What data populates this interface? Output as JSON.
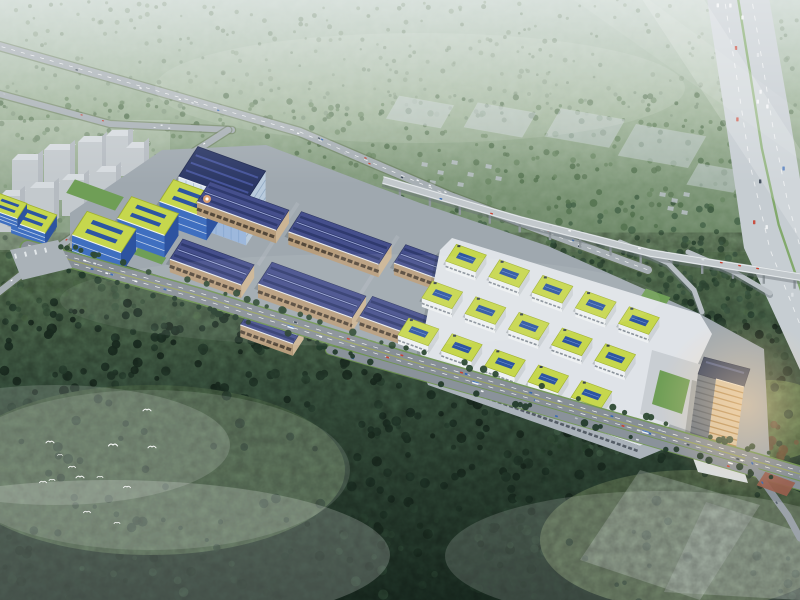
{
  "scene": {
    "canvas": {
      "w": 800,
      "h": 600
    },
    "axes": {
      "u": [
        0.94,
        0.34
      ],
      "v": [
        -0.54,
        0.84
      ],
      "pu": [
        0.97,
        0.17
      ],
      "pv": [
        -0.5,
        0.87
      ]
    },
    "palette": {
      "haze_top": "#b9c9c0",
      "forest_high": "#93ab8e",
      "forest_mid": "#5f7c5a",
      "forest_low": "#3a5541",
      "forest_dark": "#1e3126",
      "road": "#8a939b",
      "road_light": "#a7afb4",
      "verge_green": "#6f9551",
      "viaduct": "#c2c8cc",
      "expressway": "#c6cdd2",
      "median_green": "#7aa560",
      "warehouse_roof": "#454f8c",
      "warehouse_roof_dark": "#2f3a6e",
      "warehouse_wall": "#b79d7c",
      "green_roof": "#c6d74d",
      "green_roof_edge": "#9fb12f",
      "solar_blue": "#2d55a2",
      "glass_blue": "#3f6fc0",
      "hq_face": "#d9e4ef",
      "podium_white": "#dfe3e8",
      "tower_sun": "#d9c5a4",
      "tower_shade": "#6a7582",
      "city_gray": "#b6bdc3",
      "bird_white": "#ffffff",
      "sun_warm": "#ffd9a8"
    },
    "background_stops": [
      [
        0,
        "#b9c9c0"
      ],
      [
        0.18,
        "#99af93"
      ],
      [
        0.42,
        "#607d5a"
      ],
      [
        0.64,
        "#3d5843"
      ],
      [
        1,
        "#1d3025"
      ]
    ],
    "forest_zones": [
      {
        "x": 0,
        "y": 0,
        "w": 800,
        "h": 118,
        "n": 330,
        "r0": 1.2,
        "r1": 2.6,
        "o": 0.55,
        "cols": [
          "#7d947b",
          "#6f876e",
          "#84997f"
        ]
      },
      {
        "x": 0,
        "y": 95,
        "w": 800,
        "h": 125,
        "n": 380,
        "r0": 1.6,
        "r1": 3.2,
        "o": 0.75,
        "cols": [
          "#5d7a58",
          "#51704e",
          "#6a8763"
        ]
      },
      {
        "x": 0,
        "y": 195,
        "w": 800,
        "h": 125,
        "n": 420,
        "r0": 2,
        "r1": 4,
        "o": 0.85,
        "cols": [
          "#47654a",
          "#3c583f",
          "#54724f"
        ]
      },
      {
        "x": 540,
        "y": 238,
        "w": 260,
        "h": 62,
        "n": 95,
        "r0": 2,
        "r1": 3.6,
        "o": 0.9,
        "cols": [
          "#3a573f",
          "#2f4a35",
          "#44624a"
        ]
      },
      {
        "x": 540,
        "y": 280,
        "w": 260,
        "h": 175,
        "n": 250,
        "r0": 2.2,
        "r1": 4.2,
        "o": 0.9,
        "cols": [
          "#3a573f",
          "#2f4a35",
          "#44624a"
        ]
      },
      {
        "x": 0,
        "y": 300,
        "w": 800,
        "h": 300,
        "n": 680,
        "r0": 2.4,
        "r1": 5.2,
        "o": 0.92,
        "cols": [
          "#24392b",
          "#1c2f23",
          "#2d4534",
          "#203427"
        ]
      }
    ],
    "meadows": [
      {
        "cx": 150,
        "cy": 470,
        "rx": 195,
        "ry": 85,
        "fill": "#4f6a4b",
        "o": 0.88,
        "puffs": 42
      },
      {
        "cx": 690,
        "cy": 540,
        "rx": 150,
        "ry": 70,
        "fill": "#5e7454",
        "o": 0.85,
        "puffs": 26
      },
      {
        "cx": 770,
        "cy": 420,
        "rx": 62,
        "ry": 40,
        "fill": "#7fa05f",
        "o": 0.6,
        "puffs": 10
      }
    ],
    "clear_plots": [
      [
        [
          640,
          470
        ],
        [
          760,
          505
        ],
        [
          700,
          600
        ],
        [
          580,
          560
        ]
      ],
      [
        [
          706,
          502
        ],
        [
          800,
          532
        ],
        [
          800,
          600
        ],
        [
          664,
          592
        ]
      ]
    ],
    "red_trees": {
      "x": 728,
      "y": 418,
      "w": 72,
      "h": 58,
      "n": 16,
      "cols": [
        "#6e5a43",
        "#7a5f3f",
        "#585137",
        "#7d6847"
      ]
    },
    "city_blocks": [
      [
        12,
        160,
        26,
        46
      ],
      [
        44,
        150,
        26,
        50
      ],
      [
        78,
        142,
        24,
        46
      ],
      [
        106,
        136,
        22,
        40
      ],
      [
        0,
        196,
        20,
        36
      ],
      [
        30,
        188,
        24,
        40
      ],
      [
        62,
        180,
        22,
        36
      ],
      [
        96,
        172,
        20,
        32
      ],
      [
        126,
        148,
        18,
        34
      ]
    ],
    "gray_houses": [
      [
        422,
        162
      ],
      [
        438,
        170
      ],
      [
        452,
        160
      ],
      [
        468,
        172
      ],
      [
        486,
        164
      ],
      [
        430,
        180
      ],
      [
        458,
        182
      ],
      [
        496,
        176
      ],
      [
        660,
        192
      ],
      [
        672,
        198
      ],
      [
        684,
        192
      ],
      [
        668,
        206
      ],
      [
        682,
        210
      ]
    ],
    "future_plots": [
      {
        "c": [
          420,
          112
        ],
        "a": 28,
        "b": 13
      },
      {
        "c": [
          500,
          120
        ],
        "a": 30,
        "b": 14
      },
      {
        "c": [
          585,
          128
        ],
        "a": 33,
        "b": 16
      },
      {
        "c": [
          662,
          146
        ],
        "a": 36,
        "b": 18
      },
      {
        "c": [
          716,
          178
        ],
        "a": 24,
        "b": 12
      }
    ],
    "roads": {
      "roadA": {
        "pts": [
          [
            -8,
            44
          ],
          [
            140,
            86
          ],
          [
            300,
            132
          ],
          [
            450,
            196
          ],
          [
            575,
            243
          ],
          [
            648,
            270
          ]
        ],
        "w": 8,
        "cars": 22,
        "cs": 0.8
      },
      "roadB": {
        "pts": [
          [
            -8,
            92
          ],
          [
            110,
            124
          ],
          [
            232,
            130
          ]
        ],
        "w": 6,
        "cars": 6,
        "cs": 0.7
      },
      "roadNS": {
        "pts": [
          [
            228,
            130
          ],
          [
            150,
            180
          ],
          [
            80,
            232
          ],
          [
            40,
            260
          ],
          [
            -6,
            296
          ]
        ],
        "w": 6.5,
        "cars": 7,
        "cs": 0.8
      },
      "internal": {
        "pts": [
          [
            90,
            232
          ],
          [
            300,
            298
          ],
          [
            520,
            366
          ],
          [
            700,
            428
          ]
        ],
        "w": 6,
        "cars": 5,
        "cs": 0.9
      }
    },
    "boulevard": {
      "pts": [
        [
          28,
          248
        ],
        [
          200,
          296
        ],
        [
          400,
          358
        ],
        [
          600,
          416
        ],
        [
          800,
          474
        ]
      ],
      "w": 14,
      "cars": 30,
      "cs": 1,
      "buses": [
        0.34,
        0.58,
        0.8
      ],
      "service": {
        "pts": [
          [
            330,
            350
          ],
          [
            500,
            398
          ],
          [
            700,
            456
          ],
          [
            808,
            488
          ]
        ],
        "w": 8,
        "cars": 10,
        "cs": 1
      },
      "branch": {
        "pts": [
          [
            748,
            460
          ],
          [
            788,
            516
          ],
          [
            800,
            538
          ]
        ],
        "w": 7,
        "cars": 3,
        "cs": 1
      },
      "plaza": {
        "c": [
          776,
          484
        ],
        "a": 16,
        "b": 8,
        "fill": "#9a5f4e"
      },
      "side_trees": 88
    },
    "viaduct": {
      "pts": [
        [
          383,
          180
        ],
        [
          520,
          220
        ],
        [
          650,
          253
        ],
        [
          762,
          271
        ],
        [
          812,
          279
        ]
      ],
      "w": 8,
      "piers": 14,
      "cars": 9,
      "ramps": [
        [
          [
            620,
            242
          ],
          [
            668,
            263
          ],
          [
            694,
            290
          ],
          [
            702,
            312
          ]
        ],
        [
          [
            688,
            252
          ],
          [
            734,
            272
          ],
          [
            770,
            293
          ]
        ]
      ]
    },
    "expressway": {
      "left": [
        [
          706,
          -8
        ],
        [
          724,
          110
        ],
        [
          744,
          248
        ],
        [
          800,
          370
        ]
      ],
      "right": [
        [
          768,
          -8
        ],
        [
          790,
          118
        ],
        [
          808,
          228
        ]
      ],
      "cars": 14
    },
    "campus": {
      "ground": [
        [
          70,
          213
        ],
        [
          162,
          150
        ],
        [
          266,
          145
        ],
        [
          420,
          203
        ],
        [
          548,
          246
        ],
        [
          700,
          314
        ],
        [
          764,
          349
        ],
        [
          770,
          462
        ],
        [
          560,
          402
        ],
        [
          340,
          332
        ],
        [
          160,
          276
        ],
        [
          70,
          248
        ]
      ],
      "lawns": [
        {
          "c": [
            95,
            195
          ],
          "a": 26,
          "b": 8
        },
        {
          "c": [
            150,
            256
          ],
          "a": 15,
          "b": 4
        },
        {
          "c": [
            310,
            312
          ],
          "a": 22,
          "b": 4
        },
        {
          "c": [
            610,
            400
          ],
          "a": 16,
          "b": 5
        },
        {
          "c": [
            655,
            298
          ],
          "a": 13,
          "b": 6
        }
      ],
      "drives": [
        [
          [
            298,
            203
          ],
          [
            258,
            265
          ]
        ],
        [
          [
            398,
            236
          ],
          [
            358,
            298
          ]
        ],
        [
          [
            188,
            168
          ],
          [
            148,
            230
          ]
        ]
      ],
      "buildings": [
        {
          "t": "hq",
          "c": [
            222,
            174
          ],
          "a": 36,
          "b": 18,
          "h": 44
        },
        {
          "t": "greenBig",
          "c": [
            190,
            199
          ],
          "a": 25,
          "b": 13,
          "h": 22
        },
        {
          "t": "greenBig",
          "c": [
            148,
            216
          ],
          "a": 25,
          "b": 13,
          "h": 22
        },
        {
          "t": "greenBig",
          "c": [
            104,
            232
          ],
          "a": 26,
          "b": 14,
          "h": 22
        },
        {
          "t": "greenBig",
          "c": [
            34,
            218
          ],
          "a": 18,
          "b": 11,
          "h": 12
        },
        {
          "t": "greenBig",
          "c": [
            8,
            206
          ],
          "a": 15,
          "b": 9,
          "h": 10
        },
        {
          "t": "wh",
          "c": [
            243,
            206
          ],
          "a": 42,
          "b": 12,
          "h": 13
        },
        {
          "t": "wh",
          "c": [
            340,
            238
          ],
          "a": 48,
          "b": 12,
          "h": 13
        },
        {
          "t": "wh",
          "c": [
            428,
            264
          ],
          "a": 30,
          "b": 11,
          "h": 12
        },
        {
          "t": "wh",
          "c": [
            212,
            262
          ],
          "a": 38,
          "b": 12,
          "h": 13
        },
        {
          "t": "wh",
          "c": [
            312,
            290
          ],
          "a": 50,
          "b": 13,
          "h": 14
        },
        {
          "t": "wh",
          "c": [
            398,
            318
          ],
          "a": 34,
          "b": 12,
          "h": 13
        },
        {
          "t": "wh",
          "c": [
            272,
            326
          ],
          "a": 28,
          "b": 10,
          "h": 12
        }
      ],
      "podium": [
        [
          452,
          238
        ],
        [
          700,
          314
        ],
        [
          712,
          334
        ],
        [
          664,
          436
        ],
        [
          640,
          446
        ],
        [
          428,
          372
        ],
        [
          420,
          352
        ],
        [
          440,
          250
        ]
      ],
      "green_grid": {
        "origin": [
          466,
          258
        ],
        "cols": 5,
        "rows": 3,
        "du": 46,
        "dv": 44,
        "a": 16,
        "b": 10,
        "wall": 9
      },
      "trucks": {
        "p1": [
          368,
          342
        ],
        "p2": [
          424,
          360
        ],
        "n": 8
      },
      "office_tower": {
        "courtyard": [
          [
            652,
            350
          ],
          [
            712,
            368
          ],
          [
            698,
            434
          ],
          [
            640,
            414
          ]
        ],
        "shade_face": [
          [
            698,
            374
          ],
          [
            716,
            379
          ],
          [
            706,
            456
          ],
          [
            688,
            450
          ]
        ],
        "sun_face": [
          [
            716,
            379
          ],
          [
            744,
            387
          ],
          [
            734,
            464
          ],
          [
            706,
            456
          ]
        ],
        "top_face": [
          [
            698,
            374
          ],
          [
            744,
            387
          ],
          [
            750,
            369
          ],
          [
            704,
            357
          ]
        ],
        "annex": [
          [
            690,
            450
          ],
          [
            742,
            464
          ],
          [
            748,
            483
          ],
          [
            698,
            472
          ]
        ],
        "bands": 13
      }
    },
    "birds": [
      [
        147,
        410,
        4
      ],
      [
        50,
        442,
        4
      ],
      [
        113,
        445,
        4.5
      ],
      [
        152,
        447,
        4
      ],
      [
        72,
        467,
        3.5
      ],
      [
        80,
        477,
        4
      ],
      [
        43,
        482,
        3.5
      ],
      [
        52,
        480,
        3
      ],
      [
        100,
        477,
        3
      ],
      [
        127,
        487,
        3.5
      ],
      [
        87,
        512,
        3.5
      ],
      [
        117,
        523,
        3
      ],
      [
        60,
        455,
        2.5
      ]
    ],
    "fog": {
      "streaks": [
        {
          "pts": [
            [
              636,
              -10
            ],
            [
              698,
              -10
            ],
            [
              812,
              168
            ],
            [
              812,
              258
            ]
          ],
          "o": 0.18
        },
        {
          "pts": [
            [
              560,
              -10
            ],
            [
              636,
              -10
            ],
            [
              812,
              120
            ],
            [
              812,
              168
            ]
          ],
          "o": 0.08
        }
      ],
      "ellipses": [
        [
          110,
          555,
          280,
          75,
          0.2
        ],
        [
          55,
          445,
          175,
          60,
          0.15
        ],
        [
          660,
          556,
          215,
          65,
          0.15
        ],
        [
          420,
          88,
          265,
          55,
          0.1
        ],
        [
          150,
          470,
          200,
          80,
          0.12
        ],
        [
          360,
          300,
          300,
          46,
          0.07
        ]
      ],
      "top_haze_o": 0.42
    },
    "sun": {
      "glow": [
        745,
        405,
        88
      ],
      "glint": [
        207,
        199
      ]
    },
    "car_colors": [
      "#f4f6f7",
      "#f4f6f7",
      "#dde2e5",
      "#c84232",
      "#374452",
      "#3568b4",
      "#b9bec3"
    ]
  }
}
